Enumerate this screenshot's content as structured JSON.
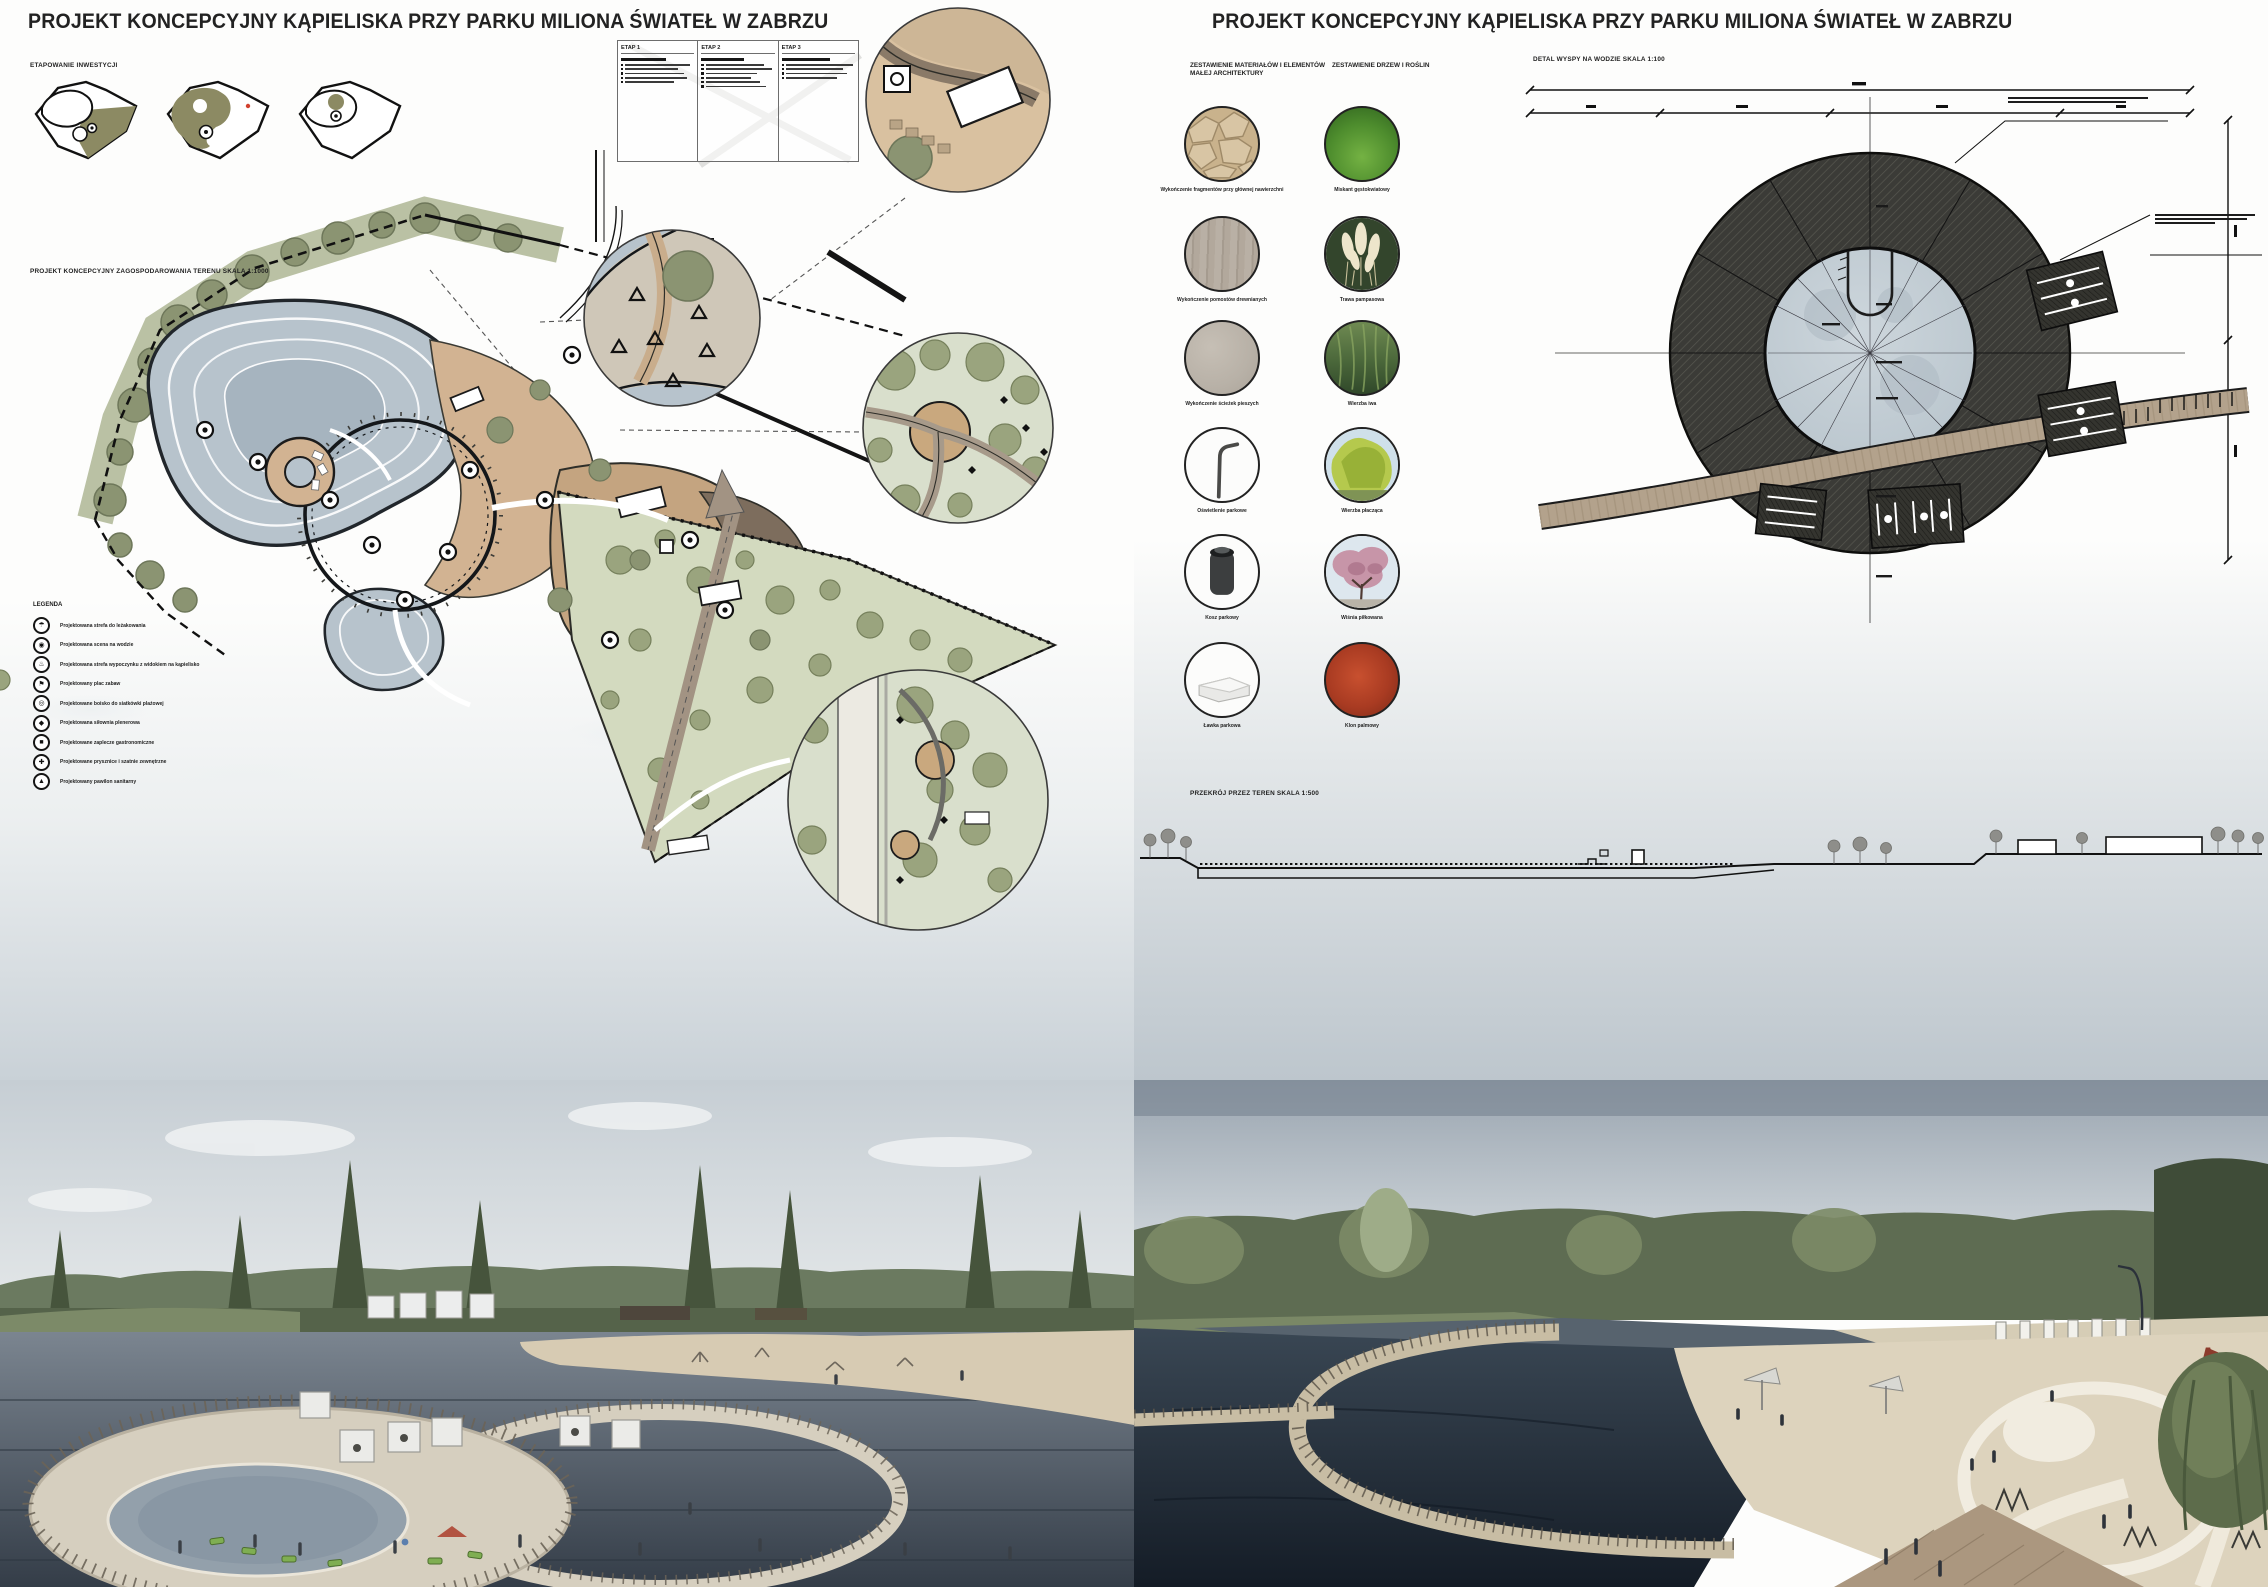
{
  "titles": {
    "left": "PROJEKT KONCEPCYJNY KĄPIELISKA PRZY PARKU MILIONA ŚWIATEŁ W ZABRZU",
    "right": "PROJEKT KONCEPCYJNY KĄPIELISKA PRZY PARKU MILIONA ŚWIATEŁ W ZABRZU"
  },
  "left_panel": {
    "staging_label": "ETAPOWANIE INWESTYCJI",
    "plan_label": "PROJEKT KONCEPCYJNY ZAGOSPODAROWANIA TERENU SKALA 1:1000",
    "stages_table": {
      "columns": [
        {
          "header": "ETAP 1"
        },
        {
          "header": "ETAP 2"
        },
        {
          "header": "ETAP 3"
        }
      ]
    },
    "legend": {
      "label": "LEGENDA",
      "items": [
        {
          "icon": "lounger-zone-icon",
          "glyph": "☂",
          "label": "Projektowana strefa do leżakowania"
        },
        {
          "icon": "water-stage-icon",
          "glyph": "◉",
          "label": "Projektowana scena na wodzie"
        },
        {
          "icon": "recreation-zone-icon",
          "glyph": "♨",
          "label": "Projektowana strefa wypoczynku z widokiem na kąpielisko"
        },
        {
          "icon": "playground-icon",
          "glyph": "⚑",
          "label": "Projektowany plac zabaw"
        },
        {
          "icon": "volleyball-icon",
          "glyph": "◎",
          "label": "Projektowane boisko do siatkówki plażowej"
        },
        {
          "icon": "outdoor-gym-icon",
          "glyph": "◆",
          "label": "Projektowana siłownia plenerowa"
        },
        {
          "icon": "gastronomy-icon",
          "glyph": "■",
          "label": "Projektowane zaplecze gastronomiczne"
        },
        {
          "icon": "showers-icon",
          "glyph": "✚",
          "label": "Projektowane prysznice i szatnie zewnętrzne"
        },
        {
          "icon": "pavilion-icon",
          "glyph": "▲",
          "label": "Projektowany pawilon sanitarny"
        }
      ]
    }
  },
  "right_panel": {
    "materials_header": "ZESTAWIENIE MATERIAŁÓW I ELEMENTÓW MAŁEJ ARCHITEKTURY",
    "plants_header": "ZESTAWIENIE DRZEW I ROŚLIN",
    "materials": [
      {
        "name": "flagstone-swatch",
        "style": "sw-flagstone",
        "art": "flagstone",
        "caption": "Wykończenie fragmentów przy głównej nawierzchni"
      },
      {
        "name": "wood-plank-swatch",
        "style": "sw-wood",
        "art": "",
        "caption": "Wykończenie pomostów drewnianych"
      },
      {
        "name": "concrete-swatch",
        "style": "sw-concrete",
        "art": "",
        "caption": "Wykończenie ścieżek pieszych"
      },
      {
        "name": "park-lamp-swatch",
        "style": "sw-white",
        "art": "lamp",
        "caption": "Oświetlenie parkowe"
      },
      {
        "name": "litter-bin-swatch",
        "style": "sw-white",
        "art": "bin",
        "caption": "Kosz parkowy"
      },
      {
        "name": "bench-swatch",
        "style": "sw-white",
        "art": "bench",
        "caption": "Ławka parkowa"
      }
    ],
    "plants": [
      {
        "name": "ornamental-grass-swatch",
        "style": "sw-grass",
        "art": "",
        "caption": "Miskant gęstokwiatowy"
      },
      {
        "name": "pampas-grass-swatch",
        "style": "",
        "art": "pampas",
        "caption": "Trawa pampasowa"
      },
      {
        "name": "willow-swatch",
        "style": "sw-willowdark",
        "art": "iwa",
        "caption": "Wierzba iwa"
      },
      {
        "name": "weeping-willow-swatch",
        "style": "",
        "art": "willow",
        "caption": "Wierzba płacząca"
      },
      {
        "name": "cherry-swatch",
        "style": "",
        "art": "cherry",
        "caption": "Wiśnia piłkowana"
      },
      {
        "name": "red-maple-swatch",
        "style": "sw-maple",
        "art": "",
        "caption": "Klon palmowy"
      }
    ],
    "island_label": "DETAL WYSPY NA WODZIE SKALA 1:100",
    "section_label": "PRZEKRÓJ PRZEZ TEREN SKALA 1:500"
  },
  "palette": {
    "plan_water": "#b7c3cc",
    "plan_trees_olive": "#8b9472",
    "plan_sand": "#d2b392",
    "island_ring_dark": "#3b3b37",
    "bridge_wood": "#b3a28c",
    "render_water_dark": "#1d2630",
    "render_sand": "#ddd3bd"
  }
}
